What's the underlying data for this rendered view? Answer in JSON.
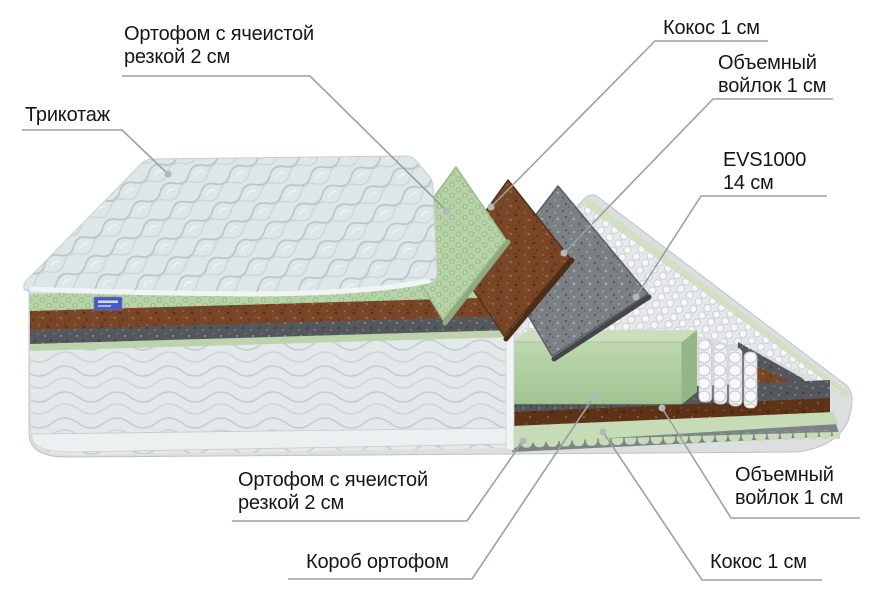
{
  "diagram": {
    "title": "Mattress layers cutaway diagram",
    "labels": {
      "ortofoam_top": {
        "line1": "Ортофом с ячеистой",
        "line2": "резкой 2 см"
      },
      "tricot": {
        "line1": "Трикотаж"
      },
      "coconut_top": {
        "line1": "Кокос 1 см"
      },
      "felt_top": {
        "line1": "Объемный",
        "line2": "войлок 1 см"
      },
      "evs": {
        "line1": "EVS1000",
        "line2": "14 см"
      },
      "ortofoam_bottom": {
        "line1": "Ортофом с ячеистой",
        "line2": "резкой 2 см"
      },
      "box": {
        "line1": "Короб ортофом"
      },
      "felt_bottom": {
        "line1": "Объемный",
        "line2": "войлок 1 см"
      },
      "coconut_bottom": {
        "line1": "Кокос 1 см"
      }
    },
    "layers": [
      {
        "name": "Трикотаж",
        "thickness": "",
        "color": "#dfe6e8"
      },
      {
        "name": "Ортофом с ячеистой резкой",
        "thickness": "2 см",
        "color": "#b7d3a8"
      },
      {
        "name": "Кокос",
        "thickness": "1 см",
        "color": "#784627"
      },
      {
        "name": "Объемный войлок",
        "thickness": "1 см",
        "color": "#7b8084"
      },
      {
        "name": "EVS1000",
        "thickness": "14 см",
        "color": "#e9ebec"
      },
      {
        "name": "Объемный войлок",
        "thickness": "1 см",
        "color": "#54585d"
      },
      {
        "name": "Кокос",
        "thickness": "1 см",
        "color": "#5d3318"
      },
      {
        "name": "Ортофом с ячеистой резкой",
        "thickness": "2 см",
        "color": "#c6dcb6"
      },
      {
        "name": "Короб ортофом",
        "thickness": "",
        "color": "#aecfa0"
      }
    ],
    "colors": {
      "text": "#161616",
      "leader_line": "#9aa0a4",
      "leader_dot": "#b2b8bc",
      "brand_tag": "#4a5ac4",
      "background": "#ffffff"
    }
  }
}
